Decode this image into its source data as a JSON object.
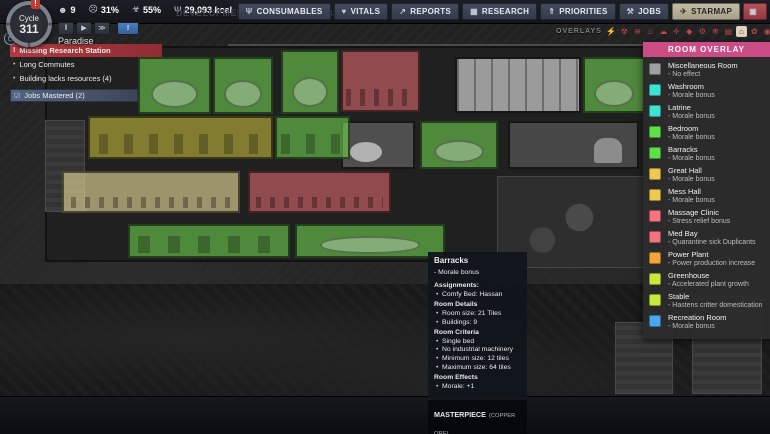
{
  "top_bar": {
    "cycle": {
      "label": "Cycle",
      "number": "311",
      "alert": "!"
    },
    "resources": [
      {
        "name": "duplicant-count",
        "icon": "☻",
        "value": "9"
      },
      {
        "name": "average-stress",
        "icon": "☹",
        "value": "31%"
      },
      {
        "name": "average-gauge",
        "icon": "☣",
        "value": "55%"
      },
      {
        "name": "calories",
        "icon": "Ψ",
        "value": "29,093 kcal"
      }
    ],
    "dev_build": "DEVELOPMENT BUILD: Q2-311032",
    "colony_name": "Paradise",
    "playback": [
      {
        "name": "pause-button",
        "g": "‖"
      },
      {
        "name": "play-button",
        "g": "▶"
      },
      {
        "name": "fast-forward-button",
        "g": "≫"
      },
      {
        "name": "alert-speed-button",
        "g": "!",
        "cls": "blue"
      }
    ],
    "menu_buttons": [
      {
        "id": "consumables",
        "icon": "Ψ",
        "label": "CONSUMABLES"
      },
      {
        "id": "vitals",
        "icon": "♥",
        "label": "VITALS"
      },
      {
        "id": "reports",
        "icon": "↗",
        "label": "REPORTS"
      },
      {
        "id": "research",
        "icon": "▦",
        "label": "RESEARCH"
      },
      {
        "id": "priorities",
        "icon": "⇑",
        "label": "PRIORITIES"
      },
      {
        "id": "jobs",
        "icon": "⚒",
        "label": "JOBS"
      },
      {
        "id": "starmap",
        "icon": "✈",
        "label": "STARMAP",
        "cls": "active"
      },
      {
        "id": "bug-report",
        "icon": "▣",
        "label": "",
        "cls": "danger"
      }
    ]
  },
  "overlays_bar": {
    "label": "OVERLAYS",
    "icons": [
      {
        "g": "⚡"
      },
      {
        "g": "☢"
      },
      {
        "g": "≋"
      },
      {
        "g": "♨"
      },
      {
        "g": "☁"
      },
      {
        "g": "✛"
      },
      {
        "g": "◆"
      },
      {
        "g": "⚙"
      },
      {
        "g": "❄"
      },
      {
        "g": "▤"
      },
      {
        "g": "⌂",
        "cls": "active"
      },
      {
        "g": "✿"
      },
      {
        "g": "◉"
      },
      {
        "g": "▦"
      }
    ]
  },
  "notifications": [
    {
      "type": "alert",
      "icon": "!",
      "text": "Missing Research Station"
    },
    {
      "type": "plain",
      "icon": "•",
      "text": "Long Commutes"
    },
    {
      "type": "plain",
      "icon": "•",
      "text": "Building lacks resources (4)"
    },
    {
      "type": "info",
      "icon": "☑",
      "text": "Jobs Mastered (2)"
    }
  ],
  "legend": {
    "title": "ROOM OVERLAY",
    "title_bg": "#cc4d86",
    "items": [
      {
        "name": "Miscellaneous Room",
        "effect": "- No effect",
        "color": "#a0a0a0"
      },
      {
        "name": "Washroom",
        "effect": "- Morale bonus",
        "color": "#3fe2d1"
      },
      {
        "name": "Latrine",
        "effect": "- Morale bonus",
        "color": "#3fe2d1"
      },
      {
        "name": "Bedroom",
        "effect": "- Morale bonus",
        "color": "#5fe049"
      },
      {
        "name": "Barracks",
        "effect": "- Morale bonus",
        "color": "#5fe049"
      },
      {
        "name": "Great Hall",
        "effect": "- Morale bonus",
        "color": "#eec84f"
      },
      {
        "name": "Mess Hall",
        "effect": "- Morale bonus",
        "color": "#eec84f"
      },
      {
        "name": "Massage Clinic",
        "effect": "- Stress relief bonus",
        "color": "#f5737e"
      },
      {
        "name": "Med Bay",
        "effect": "- Quarantine sick Duplicants",
        "color": "#f5737e"
      },
      {
        "name": "Power Plant",
        "effect": "- Power production increase",
        "color": "#f0a63a"
      },
      {
        "name": "Greenhouse",
        "effect": "- Accelerated plant growth",
        "color": "#c8e83c"
      },
      {
        "name": "Stable",
        "effect": "- Hastens critter domestication",
        "color": "#c8e83c"
      },
      {
        "name": "Recreation Room",
        "effect": "- Morale bonus",
        "color": "#4aa8ec"
      }
    ]
  },
  "tooltip": {
    "lines": [
      {
        "t": "Barracks",
        "s": "title"
      },
      {
        "t": "- Morale bonus",
        "s": "sub"
      },
      {
        "t": "Assignments:",
        "s": "header"
      },
      {
        "t": "Comfy Bed: Hassan",
        "s": "bullet"
      },
      {
        "t": "Room Details",
        "s": "header"
      },
      {
        "t": "Room size: 21 Tiles",
        "s": "bullet"
      },
      {
        "t": "Buildings: 9",
        "s": "bullet"
      },
      {
        "t": "Room Criteria",
        "s": "header"
      },
      {
        "t": "Single bed",
        "s": "bullet"
      },
      {
        "t": "No industrial machinery",
        "s": "bullet"
      },
      {
        "t": "Minimum size: 12 tiles",
        "s": "bullet"
      },
      {
        "t": "Maximum size: 64 tiles",
        "s": "bullet"
      },
      {
        "t": "Room Effects",
        "s": "header"
      },
      {
        "t": "Morale: +1",
        "s": "bullet"
      }
    ],
    "masterpiece": {
      "title": "MASTERPIECE",
      "subtitle": "(COPPER ORE)",
      "bullet": "Masterpiece"
    }
  },
  "map": {
    "colors": {
      "green": "rgba(118,224,82,0.55)",
      "yellow": "rgba(196,186,60,0.60)",
      "tan": "rgba(226,210,148,0.65)",
      "red": "rgba(221,105,110,0.60)"
    },
    "rooms": [
      {
        "x": 138,
        "y": 57,
        "w": 73,
        "h": 57,
        "color": "green",
        "f": "bed"
      },
      {
        "x": 213,
        "y": 57,
        "w": 60,
        "h": 57,
        "color": "green",
        "f": "bed"
      },
      {
        "x": 281,
        "y": 50,
        "w": 58,
        "h": 64,
        "color": "green",
        "f": "bed"
      },
      {
        "x": 341,
        "y": 50,
        "w": 79,
        "h": 62,
        "color": "red",
        "f": "tables"
      },
      {
        "x": 583,
        "y": 57,
        "w": 62,
        "h": 56,
        "color": "green",
        "f": "bed"
      },
      {
        "x": 88,
        "y": 116,
        "w": 185,
        "h": 43,
        "color": "yellow",
        "f": "machines"
      },
      {
        "x": 275,
        "y": 116,
        "w": 75,
        "h": 43,
        "color": "green",
        "f": "machines"
      },
      {
        "x": 420,
        "y": 121,
        "w": 78,
        "h": 48,
        "color": "green",
        "f": "bed"
      },
      {
        "x": 62,
        "y": 171,
        "w": 178,
        "h": 42,
        "color": "tan",
        "f": "tables"
      },
      {
        "x": 248,
        "y": 171,
        "w": 143,
        "h": 42,
        "color": "red",
        "f": "tables"
      },
      {
        "x": 128,
        "y": 224,
        "w": 162,
        "h": 34,
        "color": "green",
        "f": "dressers"
      },
      {
        "x": 295,
        "y": 224,
        "w": 150,
        "h": 34,
        "color": "green",
        "f": "bed"
      }
    ],
    "structures": [
      {
        "x": 455,
        "y": 57,
        "w": 126,
        "h": 56,
        "t": "wallpaper"
      },
      {
        "x": 341,
        "y": 121,
        "w": 74,
        "h": 48,
        "t": "bath"
      },
      {
        "x": 508,
        "y": 121,
        "w": 131,
        "h": 48,
        "t": "room-dark"
      },
      {
        "x": 497,
        "y": 176,
        "w": 150,
        "h": 92,
        "t": "machine"
      },
      {
        "x": 45,
        "y": 120,
        "w": 40,
        "h": 92,
        "t": "block"
      },
      {
        "x": 615,
        "y": 322,
        "w": 58,
        "h": 72,
        "t": "block"
      },
      {
        "x": 692,
        "y": 296,
        "w": 70,
        "h": 98,
        "t": "block"
      }
    ]
  },
  "build_menu": [
    {
      "label": "Base",
      "g": "⌂"
    },
    {
      "label": "Oxygen",
      "g": "○"
    },
    {
      "label": "Power",
      "g": "ϟ"
    },
    {
      "label": "Food",
      "g": "♨"
    },
    {
      "label": "Plumbing",
      "g": "∿"
    },
    {
      "label": "Ventilation",
      "g": "≋"
    },
    {
      "label": "Refinement",
      "g": "☰"
    },
    {
      "label": "Medicine",
      "g": "✚"
    },
    {
      "label": "Furniture",
      "g": "⊟"
    },
    {
      "label": "Stations",
      "g": "⚑"
    },
    {
      "label": "Utilities",
      "g": "⚙"
    },
    {
      "label": "Automation",
      "g": "◉"
    },
    {
      "label": "Shipping",
      "g": "▣"
    },
    {
      "label": "Rocketry",
      "g": "✈"
    }
  ],
  "tools": {
    "large": [
      {
        "label": "Dig",
        "g": "⚒",
        "name": "dig-tool"
      },
      {
        "label": "Cancel",
        "g": "✕",
        "name": "cancel-tool"
      },
      {
        "label": "Deconstruct",
        "g": "⌧",
        "name": "deconstruct-tool"
      },
      {
        "label": "Priority",
        "g": "⇑",
        "name": "priority-tool"
      }
    ],
    "small": [
      {
        "g": "⚔",
        "x": 26,
        "y": 2
      },
      {
        "g": "◉",
        "x": 48,
        "y": 2
      },
      {
        "g": "✂",
        "x": 70,
        "y": 2
      },
      {
        "g": "↯",
        "x": 15,
        "y": 18
      },
      {
        "g": "∿",
        "x": 37,
        "y": 18
      },
      {
        "g": "◌",
        "x": 59,
        "y": 18
      },
      {
        "g": "✛",
        "x": 81,
        "y": 18
      }
    ]
  }
}
